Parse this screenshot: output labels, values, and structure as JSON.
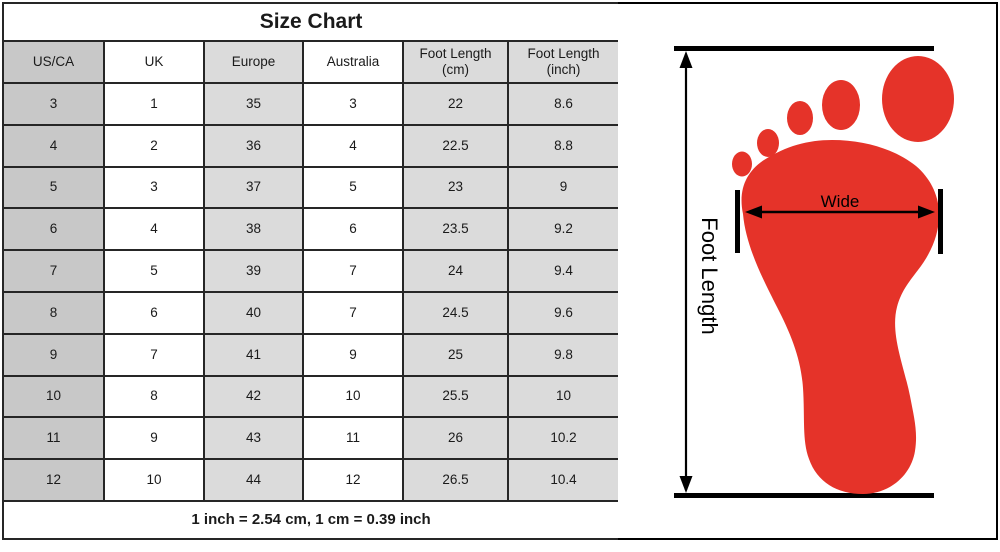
{
  "chart_data": {
    "type": "table",
    "title": "Size Chart",
    "columns": [
      "US/CA",
      "UK",
      "Europe",
      "Australia",
      "Foot Length (cm)",
      "Foot Length (inch)"
    ],
    "rows": [
      [
        "3",
        "1",
        "35",
        "3",
        "22",
        "8.6"
      ],
      [
        "4",
        "2",
        "36",
        "4",
        "22.5",
        "8.8"
      ],
      [
        "5",
        "3",
        "37",
        "5",
        "23",
        "9"
      ],
      [
        "6",
        "4",
        "38",
        "6",
        "23.5",
        "9.2"
      ],
      [
        "7",
        "5",
        "39",
        "7",
        "24",
        "9.4"
      ],
      [
        "8",
        "6",
        "40",
        "7",
        "24.5",
        "9.6"
      ],
      [
        "9",
        "7",
        "41",
        "9",
        "25",
        "9.8"
      ],
      [
        "10",
        "8",
        "42",
        "10",
        "25.5",
        "10"
      ],
      [
        "11",
        "9",
        "43",
        "11",
        "26",
        "10.2"
      ],
      [
        "12",
        "10",
        "44",
        "12",
        "26.5",
        "10.4"
      ]
    ],
    "footnote": "1 inch = 2.54 cm, 1 cm = 0.39 inch"
  },
  "diagram": {
    "length_label": "Foot Length",
    "width_label": "Wide",
    "footprint_color": "#e53329",
    "line_color": "#000000"
  },
  "colors": {
    "column_gray_dark": "#c8c8c8",
    "column_gray_light": "#dbdbdb",
    "table_border": "#262626"
  }
}
